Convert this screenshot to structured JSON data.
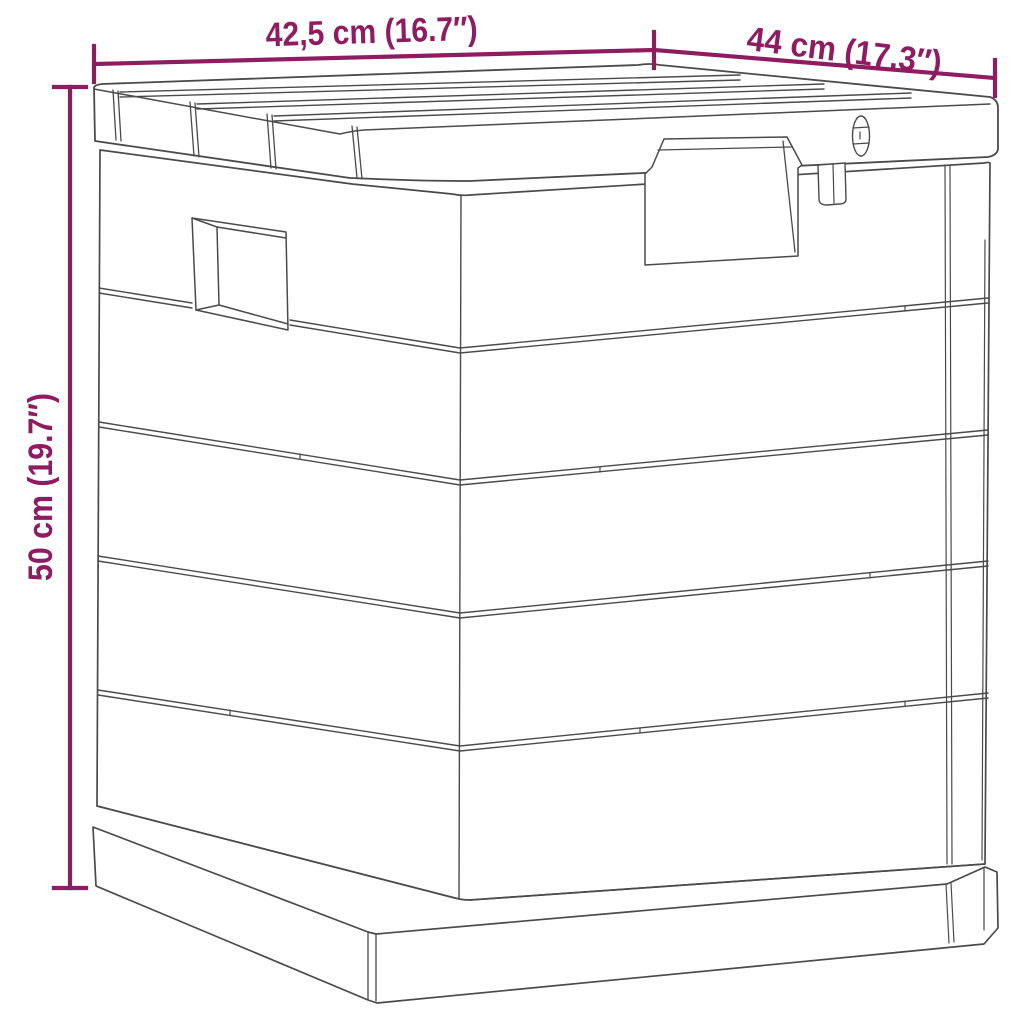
{
  "diagram": {
    "type": "product-dimension-drawing",
    "subject": "outdoor storage box line drawing",
    "background_color": "#ffffff",
    "line_color": "#4a4a4a",
    "dimension_color": "#8e1c60",
    "dimensions": {
      "width": {
        "label": "42,5 cm (16.7″)",
        "value_cm": "42,5",
        "value_in": "16.7"
      },
      "depth": {
        "label": "44 cm (17.3″)",
        "value_cm": "44",
        "value_in": "17.3"
      },
      "height": {
        "label": "50 cm (19.7″)",
        "value_cm": "50",
        "value_in": "19.7"
      }
    }
  }
}
